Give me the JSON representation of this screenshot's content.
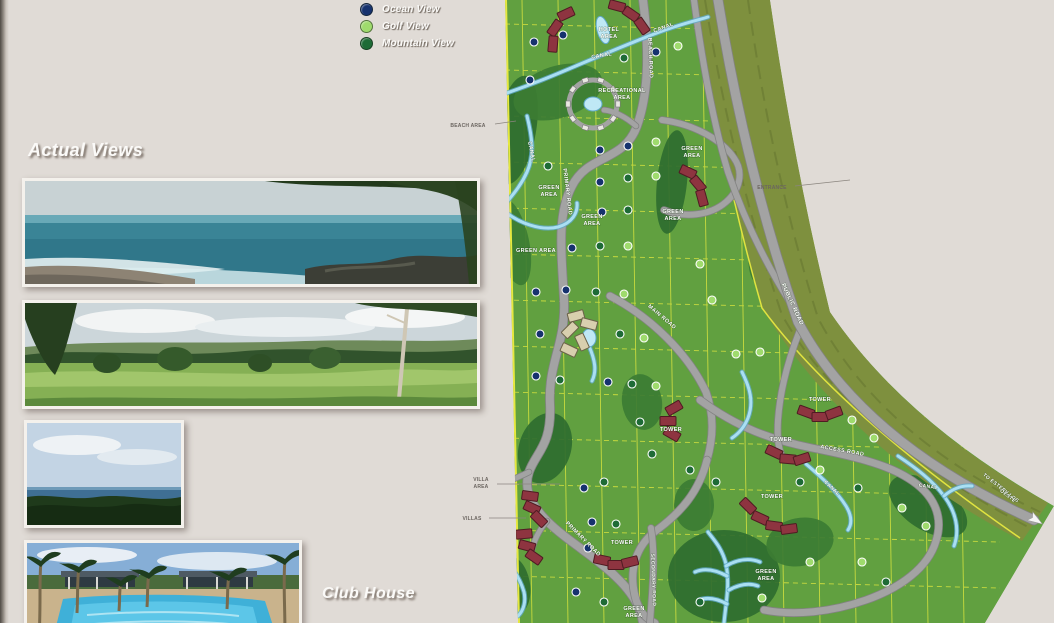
{
  "page": {
    "background": "#e0dbd6"
  },
  "legend": {
    "items": [
      {
        "label": "Ocean View",
        "color": "#16326e",
        "type": "o"
      },
      {
        "label": "Golf View",
        "color": "#9fdb6d",
        "type": "g"
      },
      {
        "label": "Mountain View",
        "color": "#1e6b36",
        "type": "m"
      }
    ]
  },
  "sections": {
    "actual_views_title": "Actual Views",
    "club_house_title": "Club House"
  },
  "photos": [
    {
      "name": "ocean-beach-photo"
    },
    {
      "name": "mountain-pasture-photo"
    },
    {
      "name": "ocean-horizon-photo"
    },
    {
      "name": "club-house-pool-photo"
    }
  ],
  "map": {
    "colors": {
      "base": "#61a040",
      "dark": "#2f6d2f",
      "dark2": "#3c7c33",
      "corridor": "#7e903e",
      "corridorStripe": "#6d7d34",
      "road": "#a3a3a3",
      "roadEdge": "#828282",
      "canal": "#aadff2",
      "canalEdge": "#5fa9c9",
      "pond": "#bfe8f5",
      "building": "#8e3440",
      "buildingEdge": "#4f1b22",
      "clubBuilding": "#d8cfae",
      "clubBuildingEdge": "#6b6248",
      "recBuilding": "#e9e7e2",
      "recBuildingEdge": "#777777",
      "lotLine": "#d9e43f",
      "boundary": "#e6e840",
      "label": "#ffffff",
      "annotation": "#6b6560",
      "arrow": "#f5f5f5"
    },
    "labels": [
      {
        "t": "HOTEL",
        "x": 609,
        "y": 31,
        "r": 0,
        "s": 5.5
      },
      {
        "t": "AREA",
        "x": 609,
        "y": 38,
        "r": 0,
        "s": 5.5
      },
      {
        "t": "CANAL",
        "x": 664,
        "y": 29,
        "r": -20,
        "s": 5.5
      },
      {
        "t": "CANAL",
        "x": 602,
        "y": 57,
        "r": -10,
        "s": 5.5
      },
      {
        "t": "RECREATIONAL",
        "x": 622,
        "y": 92,
        "r": 0,
        "s": 5.5
      },
      {
        "t": "AREA",
        "x": 622,
        "y": 99,
        "r": 0,
        "s": 5.5
      },
      {
        "t": "BEACH ROAD",
        "x": 649,
        "y": 58,
        "r": 88,
        "s": 5.5
      },
      {
        "t": "GREEN",
        "x": 692,
        "y": 150,
        "r": 0,
        "s": 5.5
      },
      {
        "t": "AREA",
        "x": 692,
        "y": 157,
        "r": 0,
        "s": 5.5
      },
      {
        "t": "CANAL",
        "x": 530,
        "y": 152,
        "r": 78,
        "s": 5.5
      },
      {
        "t": "GREEN",
        "x": 549,
        "y": 189,
        "r": 0,
        "s": 5.5
      },
      {
        "t": "AREA",
        "x": 549,
        "y": 196,
        "r": 0,
        "s": 5.5
      },
      {
        "t": "GREEN",
        "x": 592,
        "y": 218,
        "r": 0,
        "s": 5.5
      },
      {
        "t": "AREA",
        "x": 592,
        "y": 225,
        "r": 0,
        "s": 5.5
      },
      {
        "t": "GREEN",
        "x": 673,
        "y": 213,
        "r": 0,
        "s": 5.5
      },
      {
        "t": "AREA",
        "x": 673,
        "y": 220,
        "r": 0,
        "s": 5.5
      },
      {
        "t": "PRIMARY ROAD",
        "x": 566,
        "y": 192,
        "r": 83,
        "s": 5.5
      },
      {
        "t": "GREEN AREA",
        "x": 536,
        "y": 252,
        "r": 0,
        "s": 5.5
      },
      {
        "t": "MAIN ROAD",
        "x": 661,
        "y": 318,
        "r": 40,
        "s": 5.5
      },
      {
        "t": "PUBLIC ROAD",
        "x": 791,
        "y": 305,
        "r": 65,
        "s": 6
      },
      {
        "t": "TOWER",
        "x": 671,
        "y": 431,
        "r": 0,
        "s": 5.5
      },
      {
        "t": "TOWER",
        "x": 820,
        "y": 401,
        "r": 0,
        "s": 5.5
      },
      {
        "t": "TOWER",
        "x": 781,
        "y": 441,
        "r": 0,
        "s": 5.5
      },
      {
        "t": "ACCESS ROAD",
        "x": 842,
        "y": 452,
        "r": 10,
        "s": 5.5
      },
      {
        "t": "CANAL",
        "x": 831,
        "y": 489,
        "r": 42,
        "s": 5
      },
      {
        "t": "CANAL",
        "x": 928,
        "y": 488,
        "r": 8,
        "s": 5
      },
      {
        "t": "TOWER",
        "x": 772,
        "y": 498,
        "r": 0,
        "s": 5.5
      },
      {
        "t": "PRIMARY ROAD",
        "x": 582,
        "y": 540,
        "r": 45,
        "s": 5.5
      },
      {
        "t": "TOWER",
        "x": 622,
        "y": 544,
        "r": 0,
        "s": 5.5
      },
      {
        "t": "SECONDARY ROAD",
        "x": 652,
        "y": 580,
        "r": 88,
        "s": 5
      },
      {
        "t": "GREEN",
        "x": 634,
        "y": 610,
        "r": 0,
        "s": 5.5
      },
      {
        "t": "AREA",
        "x": 634,
        "y": 617,
        "r": 0,
        "s": 5.5
      },
      {
        "t": "GREEN",
        "x": 766,
        "y": 573,
        "r": 0,
        "s": 5.5
      },
      {
        "t": "AREA",
        "x": 766,
        "y": 580,
        "r": 0,
        "s": 5.5
      },
      {
        "t": "TO ESTERILLOS",
        "x": 1000,
        "y": 489,
        "r": 38,
        "s": 5
      },
      {
        "t": "OESTE",
        "x": 1007,
        "y": 497,
        "r": 38,
        "s": 5
      }
    ],
    "annotations": [
      {
        "text": "BEACH AREA",
        "x": 468,
        "y": 127,
        "leader": [
          495,
          124,
          516,
          121
        ]
      },
      {
        "text": "VILLA",
        "x": 481,
        "y": 481
      },
      {
        "text": "AREA",
        "x": 481,
        "y": 488,
        "leader": [
          497,
          484,
          560,
          484
        ]
      },
      {
        "text": "VILLAS",
        "x": 472,
        "y": 520,
        "leader": [
          489,
          518,
          526,
          518
        ]
      },
      {
        "text": "ENTRANCE",
        "x": 772,
        "y": 189,
        "leader": [
          795,
          186,
          850,
          180
        ]
      }
    ],
    "badge_colors": {
      "o": "#16326e",
      "g": "#9fdb6d",
      "m": "#1e6b36"
    },
    "badges": [
      [
        534,
        42,
        "o"
      ],
      [
        563,
        35,
        "o"
      ],
      [
        530,
        80,
        "o"
      ],
      [
        624,
        58,
        "m"
      ],
      [
        656,
        52,
        "o"
      ],
      [
        678,
        46,
        "g"
      ],
      [
        548,
        166,
        "m"
      ],
      [
        600,
        150,
        "o"
      ],
      [
        628,
        146,
        "o"
      ],
      [
        656,
        142,
        "g"
      ],
      [
        600,
        182,
        "o"
      ],
      [
        628,
        178,
        "m"
      ],
      [
        656,
        176,
        "g"
      ],
      [
        602,
        212,
        "o"
      ],
      [
        628,
        210,
        "m"
      ],
      [
        572,
        248,
        "o"
      ],
      [
        600,
        246,
        "m"
      ],
      [
        628,
        246,
        "g"
      ],
      [
        536,
        292,
        "o"
      ],
      [
        566,
        290,
        "o"
      ],
      [
        596,
        292,
        "m"
      ],
      [
        624,
        294,
        "g"
      ],
      [
        540,
        334,
        "o"
      ],
      [
        620,
        334,
        "m"
      ],
      [
        644,
        338,
        "g"
      ],
      [
        536,
        376,
        "o"
      ],
      [
        560,
        380,
        "m"
      ],
      [
        608,
        382,
        "o"
      ],
      [
        632,
        384,
        "m"
      ],
      [
        656,
        386,
        "g"
      ],
      [
        700,
        264,
        "g"
      ],
      [
        712,
        300,
        "g"
      ],
      [
        736,
        354,
        "g"
      ],
      [
        760,
        352,
        "g"
      ],
      [
        640,
        422,
        "m"
      ],
      [
        652,
        454,
        "m"
      ],
      [
        690,
        470,
        "m"
      ],
      [
        716,
        482,
        "m"
      ],
      [
        800,
        482,
        "m"
      ],
      [
        820,
        470,
        "g"
      ],
      [
        852,
        420,
        "g"
      ],
      [
        874,
        438,
        "g"
      ],
      [
        858,
        488,
        "m"
      ],
      [
        902,
        508,
        "g"
      ],
      [
        926,
        526,
        "g"
      ],
      [
        584,
        488,
        "o"
      ],
      [
        604,
        482,
        "m"
      ],
      [
        592,
        522,
        "o"
      ],
      [
        616,
        524,
        "m"
      ],
      [
        588,
        548,
        "o"
      ],
      [
        576,
        592,
        "o"
      ],
      [
        604,
        602,
        "m"
      ],
      [
        700,
        602,
        "m"
      ],
      [
        762,
        598,
        "g"
      ],
      [
        810,
        562,
        "g"
      ],
      [
        862,
        562,
        "g"
      ],
      [
        886,
        582,
        "m"
      ]
    ],
    "arrow": {
      "x": 1030,
      "y": 516,
      "rot": 33
    }
  }
}
